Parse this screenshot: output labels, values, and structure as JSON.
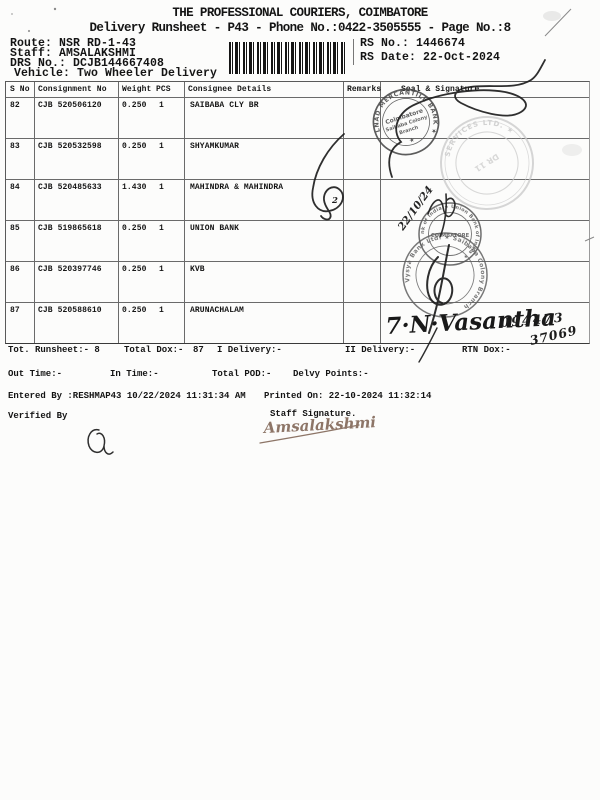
{
  "header": {
    "title": "THE PROFESSIONAL COURIERS, COIMBATORE",
    "subtitle": "Delivery Runsheet - P43 - Phone No.:0422-3505555 - Page No.:8",
    "route": "Route: NSR RD-1-43",
    "staff": "Staff: AMSALAKSHMI",
    "drs_no": "DRS No.: DCJB144667408",
    "vehicle": "Vehicle: Two Wheeler Delivery",
    "rs_no": "RS No.: 1446674",
    "rs_date": "RS Date: 22-Oct-2024"
  },
  "table": {
    "columns": [
      "S No",
      "Consignment No",
      "Weight",
      "PCS",
      "Consignee Details",
      "Remarks",
      "Seal & Signature"
    ],
    "rows": [
      {
        "s_no": "82",
        "consignment_no": "CJB 520506120",
        "weight": "0.250",
        "pcs": "1",
        "consignee": "SAIBABA CLY BR"
      },
      {
        "s_no": "83",
        "consignment_no": "CJB 520532598",
        "weight": "0.250",
        "pcs": "1",
        "consignee": "SHYAMKUMAR"
      },
      {
        "s_no": "84",
        "consignment_no": "CJB 520485633",
        "weight": "1.430",
        "pcs": "1",
        "consignee": "MAHINDRA & MAHINDRA"
      },
      {
        "s_no": "85",
        "consignment_no": "CJB 519865618",
        "weight": "0.250",
        "pcs": "1",
        "consignee": "UNION BANK"
      },
      {
        "s_no": "86",
        "consignment_no": "CJB 520397746",
        "weight": "0.250",
        "pcs": "1",
        "consignee": "KVB"
      },
      {
        "s_no": "87",
        "consignment_no": "CJB 520588610",
        "weight": "0.250",
        "pcs": "1",
        "consignee": "ARUNACHALAM"
      }
    ]
  },
  "summary": {
    "tot_runsheet": "Tot. Runsheet:- 8",
    "total_dox_label": "Total Dox:-",
    "total_dox_value": "87",
    "i_delivery": "I Delivery:-",
    "ii_delivery": "II Delivery:-",
    "rtn_dox": "RTN Dox:-",
    "out_time": "Out Time:-",
    "in_time": "In Time:-",
    "total_pod": "Total POD:-",
    "delvy_points": "Delvy Points:-",
    "entered_by": "Entered By :RESHMAP43 10/22/2024 11:31:34 AM",
    "printed_on": "Printed On: 22-10-2024 11:32:14",
    "verified_by": "Verified By",
    "staff_signature": "Staff Signature."
  },
  "stamps": {
    "tamilnad": {
      "ring": "TAMILNAD MERCANTILE BANK ★",
      "line1": "Coimbatore",
      "line2": "Saibaba Colony",
      "line3": "Branch",
      "star": "★"
    },
    "services": {
      "ring": "SERVICES LTD. ★",
      "inner": "DR 11"
    },
    "union_bank": {
      "ring": "Union Bank of India ★ Union Bank of India ★",
      "center": "COIMBATORE"
    },
    "karur": {
      "ring": "★ The Karur Vysya Bank Ltd. ★ Saibaba Colony Branch"
    }
  },
  "handwriting": {
    "date_note": "22/10/24",
    "row84_mark": "2",
    "runner_signature": "7·N·Vasantha",
    "phone_part1": "094473",
    "phone_part2": "37069",
    "staff_sig": "Amsalakshmi"
  }
}
